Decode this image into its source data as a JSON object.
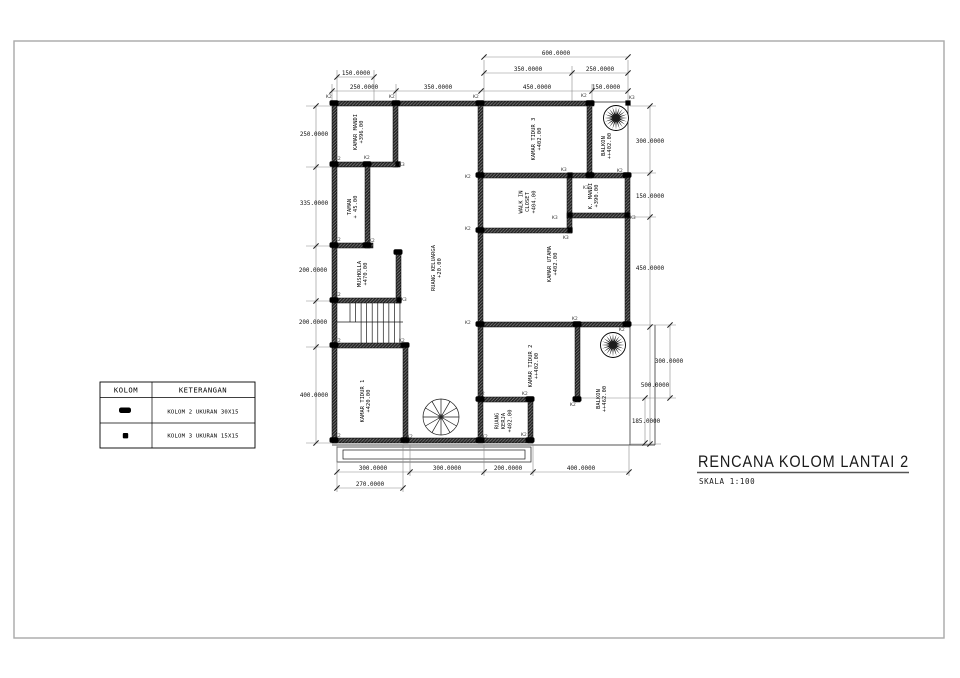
{
  "page": {
    "background": "#ffffff",
    "frame_color": "#a9a9a9",
    "line_color": "#1a1a1a"
  },
  "title_block": {
    "title": "RENCANA KOLOM LANTAI 2",
    "scale_label": "SKALA 1:100"
  },
  "legend": {
    "headers": {
      "col1": "KOLOM",
      "col2": "KETERANGAN"
    },
    "rows": [
      {
        "symbol": "kolom-2-marker",
        "label": "KOLOM 2 UKURAN 30X15"
      },
      {
        "symbol": "kolom-3-marker",
        "label": "KOLOM 3 UKURAN 15X15"
      }
    ]
  },
  "rooms": [
    {
      "lines": [
        "KAMAR MANDI",
        "+396.00"
      ],
      "x": 360,
      "y": 132
    },
    {
      "lines": [
        "TAMAN",
        "+ 45.00"
      ],
      "x": 354,
      "y": 207
    },
    {
      "lines": [
        "MUSHOLLA",
        "+470.00"
      ],
      "x": 364,
      "y": 274
    },
    {
      "lines": [
        "RUANG KELUARGA",
        "+20.00"
      ],
      "x": 438,
      "y": 268
    },
    {
      "lines": [
        "KAMAR TIDUR 3",
        "+402.00"
      ],
      "x": 538,
      "y": 139
    },
    {
      "lines": [
        "BALKON",
        "++402.00"
      ],
      "x": 608,
      "y": 146
    },
    {
      "lines": [
        "WALK IN",
        "CLOSET",
        "+404.00"
      ],
      "x": 529,
      "y": 202
    },
    {
      "lines": [
        "K. MANDI",
        "+390.00"
      ],
      "x": 595,
      "y": 196
    },
    {
      "lines": [
        "KAMAR UTAMA",
        "+402.00"
      ],
      "x": 554,
      "y": 264
    },
    {
      "lines": [
        "KAMAR TIDUR 2",
        "++402.00"
      ],
      "x": 535,
      "y": 366
    },
    {
      "lines": [
        "BALKON",
        "++462.00"
      ],
      "x": 603,
      "y": 399
    },
    {
      "lines": [
        "KAMAR TIDUR 1",
        "+420.00"
      ],
      "x": 367,
      "y": 401
    },
    {
      "lines": [
        "RUANG",
        "KERJA",
        "+402.00"
      ],
      "x": 505,
      "y": 421
    }
  ],
  "dimensions": [
    {
      "text": "600.0000",
      "x": 556,
      "y": 55
    },
    {
      "text": "350.0000",
      "x": 528,
      "y": 71
    },
    {
      "text": "250.0000",
      "x": 600,
      "y": 71
    },
    {
      "text": "150.0000",
      "x": 356,
      "y": 75
    },
    {
      "text": "250.0000",
      "x": 364,
      "y": 89
    },
    {
      "text": "350.0000",
      "x": 438,
      "y": 89
    },
    {
      "text": "450.0000",
      "x": 537,
      "y": 89
    },
    {
      "text": "150.0000",
      "x": 606,
      "y": 89
    },
    {
      "text": "250.0000",
      "x": 314,
      "y": 136
    },
    {
      "text": "335.0000",
      "x": 314,
      "y": 205
    },
    {
      "text": "200.0000",
      "x": 313,
      "y": 272
    },
    {
      "text": "200.0000",
      "x": 313,
      "y": 324
    },
    {
      "text": "400.0000",
      "x": 314,
      "y": 397
    },
    {
      "text": "300.0000",
      "x": 650,
      "y": 143
    },
    {
      "text": "150.0000",
      "x": 650,
      "y": 198
    },
    {
      "text": "450.0000",
      "x": 650,
      "y": 270
    },
    {
      "text": "300.0000",
      "x": 669,
      "y": 363
    },
    {
      "text": "500.0000",
      "x": 655,
      "y": 387
    },
    {
      "text": "185.0000",
      "x": 646,
      "y": 423
    },
    {
      "text": "300.0000",
      "x": 373,
      "y": 470
    },
    {
      "text": "300.0000",
      "x": 447,
      "y": 470
    },
    {
      "text": "200.0000",
      "x": 508,
      "y": 470
    },
    {
      "text": "400.0000",
      "x": 581,
      "y": 470
    },
    {
      "text": "270.0000",
      "x": 370,
      "y": 486
    }
  ],
  "column_markers": [
    {
      "type": "K2",
      "x": 334,
      "y": 103
    },
    {
      "type": "K2",
      "x": 396,
      "y": 103
    },
    {
      "type": "K2",
      "x": 480,
      "y": 103
    },
    {
      "type": "K2",
      "x": 590,
      "y": 103
    },
    {
      "type": "K3",
      "x": 628,
      "y": 103
    },
    {
      "type": "K2",
      "x": 334,
      "y": 164
    },
    {
      "type": "K2",
      "x": 367,
      "y": 164
    },
    {
      "type": "K3",
      "x": 398,
      "y": 164
    },
    {
      "type": "K2",
      "x": 480,
      "y": 175
    },
    {
      "type": "K3",
      "x": 570,
      "y": 175
    },
    {
      "type": "K2",
      "x": 627,
      "y": 175
    },
    {
      "type": "K2",
      "x": 590,
      "y": 175
    },
    {
      "type": "K3",
      "x": 570,
      "y": 215
    },
    {
      "type": "K3",
      "x": 627,
      "y": 215
    },
    {
      "type": "K2",
      "x": 480,
      "y": 230
    },
    {
      "type": "K3",
      "x": 570,
      "y": 230
    },
    {
      "type": "K2",
      "x": 334,
      "y": 245
    },
    {
      "type": "K2",
      "x": 367,
      "y": 245
    },
    {
      "type": "K2",
      "x": 398,
      "y": 252
    },
    {
      "type": "K2",
      "x": 334,
      "y": 300
    },
    {
      "type": "K3",
      "x": 399,
      "y": 300
    },
    {
      "type": "K2",
      "x": 480,
      "y": 324
    },
    {
      "type": "K2",
      "x": 577,
      "y": 324
    },
    {
      "type": "K2",
      "x": 627,
      "y": 324
    },
    {
      "type": "K2",
      "x": 334,
      "y": 345
    },
    {
      "type": "K2",
      "x": 405,
      "y": 345
    },
    {
      "type": "K2",
      "x": 480,
      "y": 399
    },
    {
      "type": "K2",
      "x": 530,
      "y": 399
    },
    {
      "type": "K2",
      "x": 577,
      "y": 399
    },
    {
      "type": "K2",
      "x": 334,
      "y": 440
    },
    {
      "type": "K2",
      "x": 405,
      "y": 440
    },
    {
      "type": "K2",
      "x": 480,
      "y": 440
    },
    {
      "type": "K2",
      "x": 530,
      "y": 440
    }
  ],
  "column_labels": [
    {
      "text": "K2",
      "x": 326,
      "y": 98
    },
    {
      "text": "K2",
      "x": 389,
      "y": 98
    },
    {
      "text": "K2",
      "x": 473,
      "y": 98
    },
    {
      "text": "K2",
      "x": 581,
      "y": 97
    },
    {
      "text": "K3",
      "x": 629,
      "y": 99
    },
    {
      "text": "K2",
      "x": 335,
      "y": 160
    },
    {
      "text": "K2",
      "x": 364,
      "y": 159
    },
    {
      "text": "K3",
      "x": 399,
      "y": 166
    },
    {
      "text": "K2",
      "x": 465,
      "y": 178
    },
    {
      "text": "K3",
      "x": 561,
      "y": 171
    },
    {
      "text": "K2",
      "x": 617,
      "y": 172
    },
    {
      "text": "K3",
      "x": 583,
      "y": 189
    },
    {
      "text": "K3",
      "x": 552,
      "y": 219
    },
    {
      "text": "K3",
      "x": 630,
      "y": 219
    },
    {
      "text": "K2",
      "x": 465,
      "y": 230
    },
    {
      "text": "K3",
      "x": 563,
      "y": 239
    },
    {
      "text": "K2",
      "x": 335,
      "y": 241
    },
    {
      "text": "K2",
      "x": 369,
      "y": 242
    },
    {
      "text": "K2",
      "x": 335,
      "y": 296
    },
    {
      "text": "K3",
      "x": 401,
      "y": 301
    },
    {
      "text": "K2",
      "x": 465,
      "y": 324
    },
    {
      "text": "K2",
      "x": 572,
      "y": 320
    },
    {
      "text": "K2",
      "x": 619,
      "y": 331
    },
    {
      "text": "K2",
      "x": 335,
      "y": 342
    },
    {
      "text": "K2",
      "x": 399,
      "y": 342
    },
    {
      "text": "K2",
      "x": 479,
      "y": 395
    },
    {
      "text": "K2",
      "x": 522,
      "y": 395
    },
    {
      "text": "K2",
      "x": 570,
      "y": 406
    },
    {
      "text": "K2",
      "x": 335,
      "y": 437
    },
    {
      "text": "K2",
      "x": 407,
      "y": 438
    },
    {
      "text": "K2",
      "x": 482,
      "y": 438
    },
    {
      "text": "K2",
      "x": 521,
      "y": 436
    }
  ]
}
